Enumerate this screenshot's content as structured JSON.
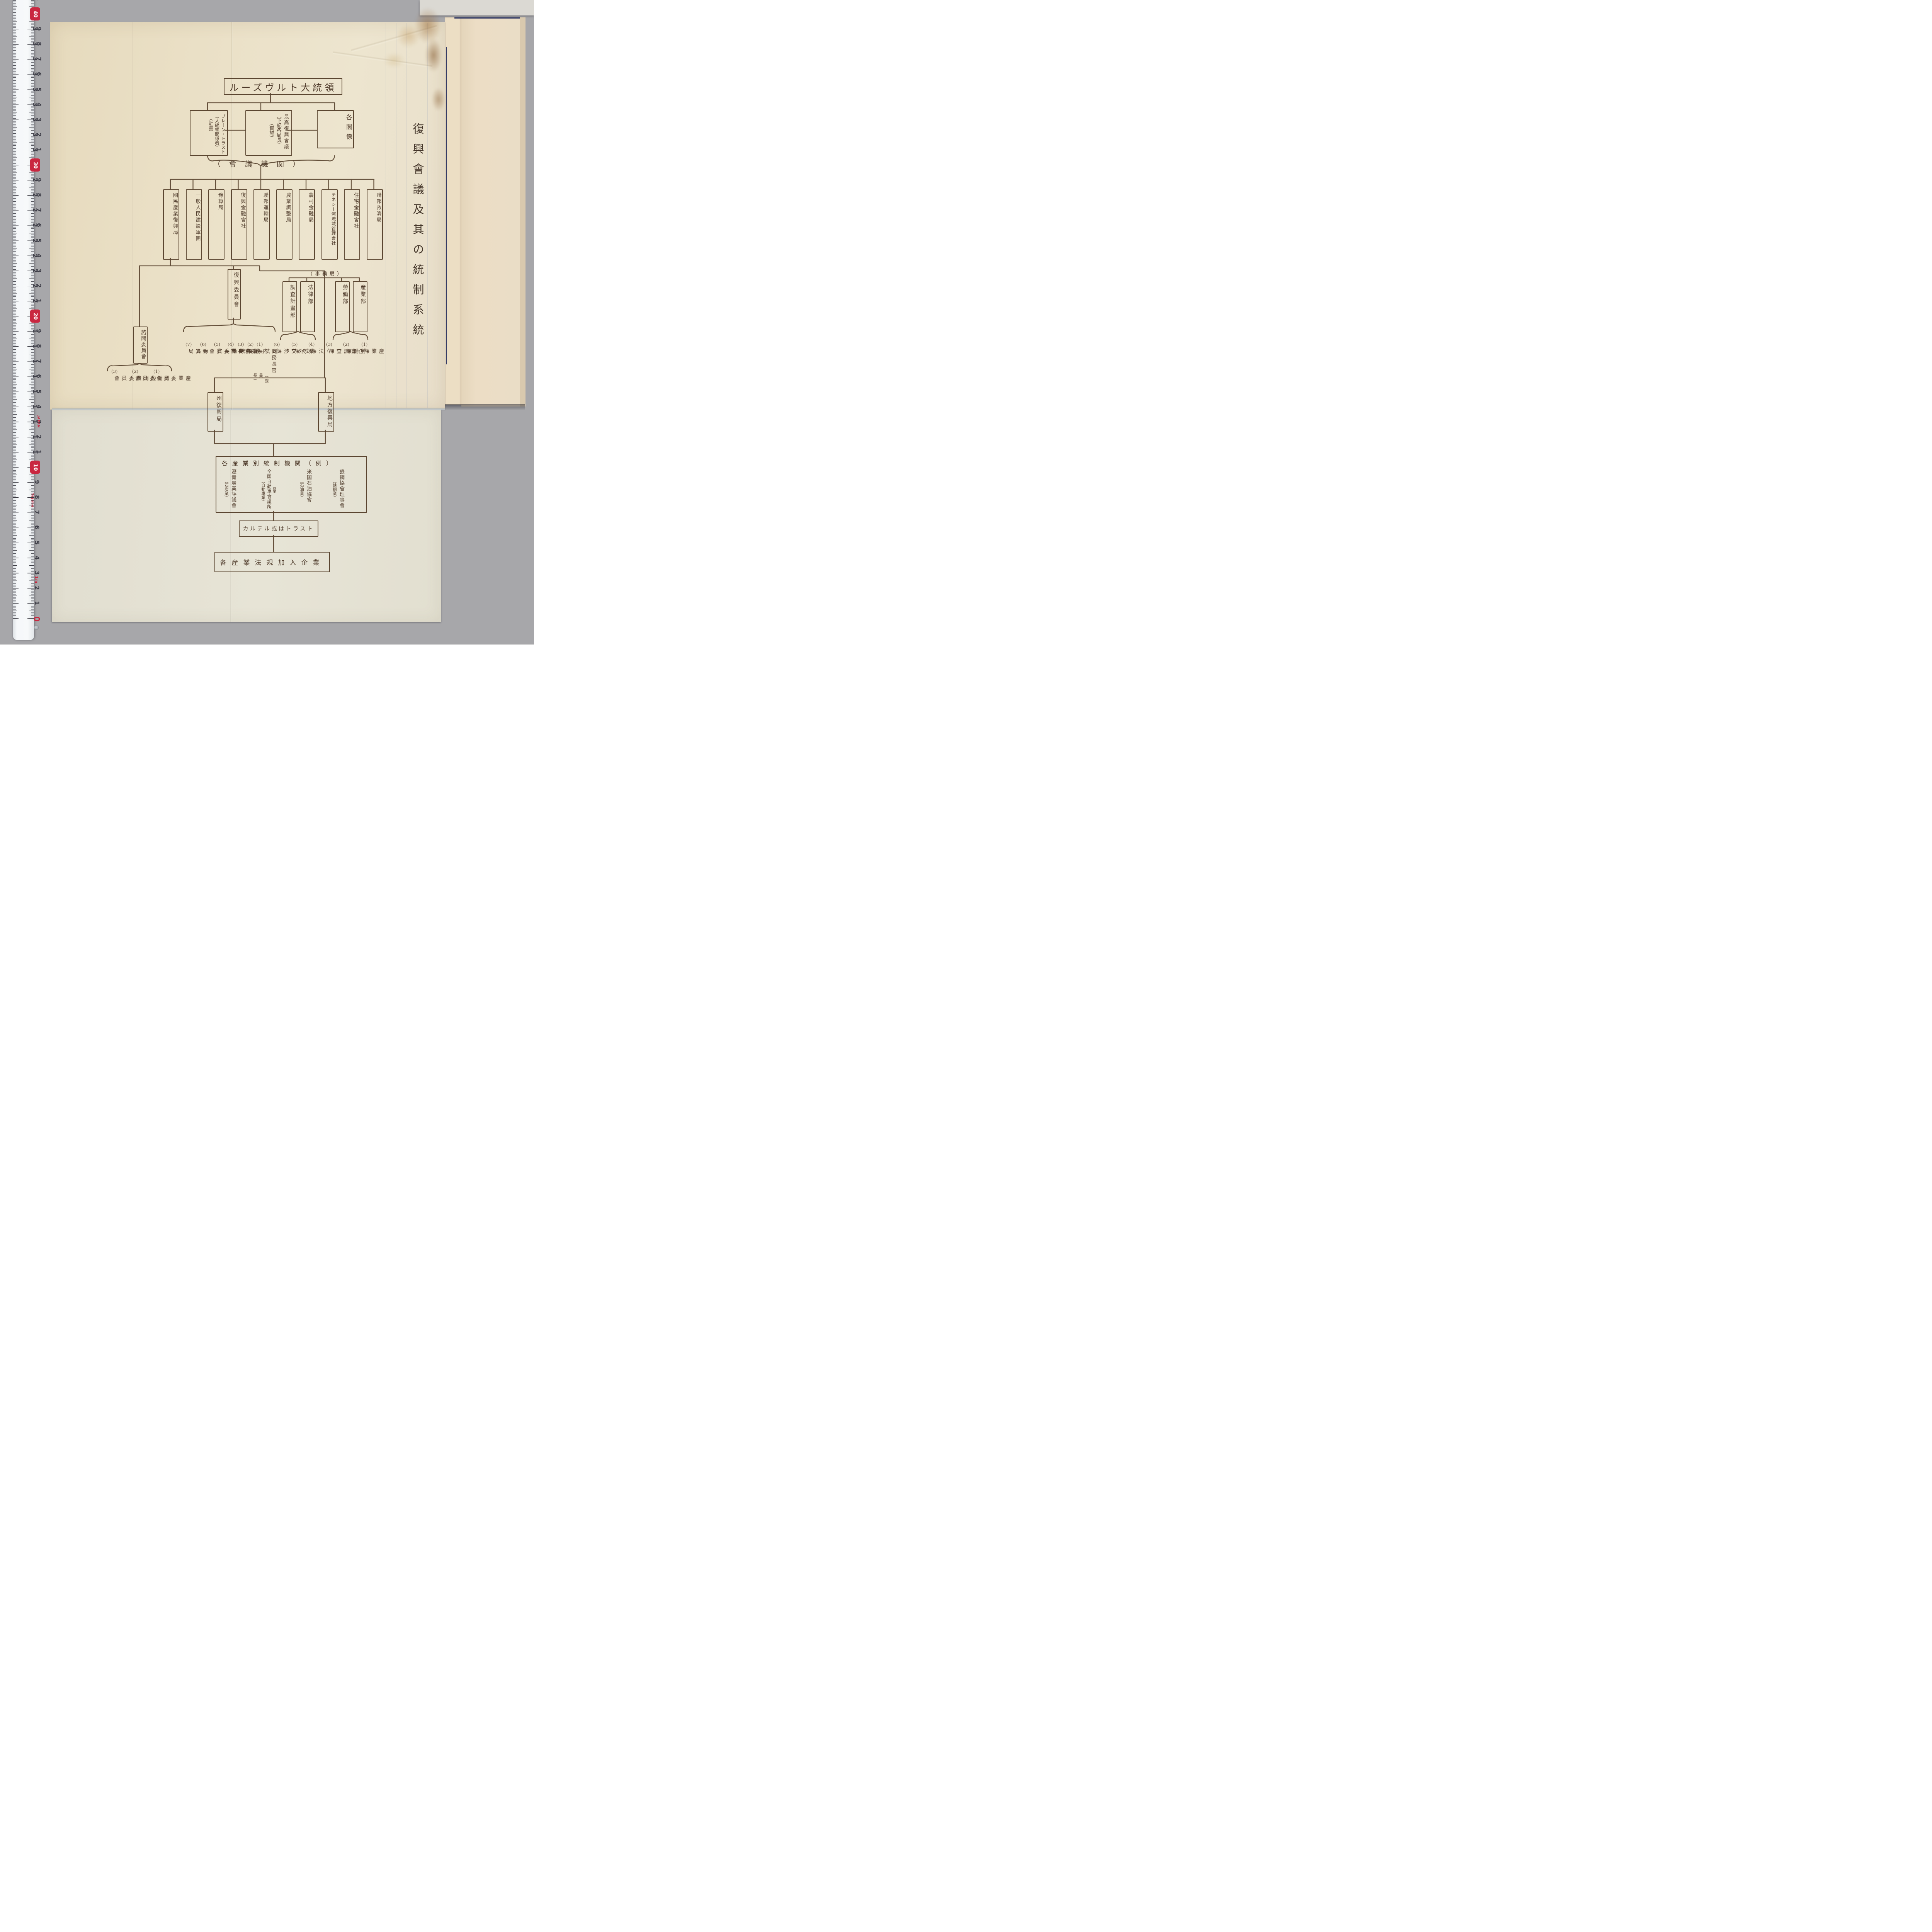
{
  "document": {
    "side_title": "復興會議及其の統制系統",
    "chart": {
      "president": "ルーズヴルト大統領",
      "row2": {
        "brain_trust": [
          "ブレーン・トラスト",
          "（大統領関係者）",
          "（計畫）"
        ],
        "supreme_council": [
          "最高復興會議",
          "（下記各局長）",
          "（實施）"
        ],
        "cabinet": "各閣僚"
      },
      "council_label": "（會議機関）",
      "agencies": [
        "國民産業復興局",
        "一般人民建設軍團",
        "豫算局",
        "復興金融會社",
        "聯邦運輸局",
        "農業調整局",
        "農村金融局",
        "テネシー河流域管理會社",
        "住宅金融會社",
        "聯邦救濟局"
      ],
      "recovery_committee": "復興委員會",
      "committee_members": [
        {
          "no": "(1)",
          "label": "商務長官",
          "sub": "（委員長）"
        },
        {
          "no": "(2)",
          "label": "司法長官",
          "sub": ""
        },
        {
          "no": "(3)",
          "label": "内務長官",
          "sub": ""
        },
        {
          "no": "(4)",
          "label": "農務長官",
          "sub": ""
        },
        {
          "no": "(5)",
          "label": "勞働長官",
          "sub": ""
        },
        {
          "no": "(6)",
          "label": "聯邦商業委員會",
          "sub": "議長"
        },
        {
          "no": "(7)",
          "label": "豫算局",
          "sub": ""
        }
      ],
      "secretariat_label": "（事務局）",
      "departments": [
        "調査計畫部",
        "法律部",
        "勞働部",
        "産業部"
      ],
      "dept_sections": [
        {
          "no": "(1)",
          "label": "産業課"
        },
        {
          "no": "(2)",
          "label": "勞働課"
        },
        {
          "no": "(3)",
          "label": "企畫調査課"
        },
        {
          "no": "(4)",
          "label": "立法課"
        },
        {
          "no": "(5)",
          "label": "業務課"
        },
        {
          "no": "(6)",
          "label": "對外交渉課"
        }
      ],
      "advisory_committee": "諮問委員會",
      "advisory_boards": [
        {
          "no": "(1)",
          "label": "産業委員會"
        },
        {
          "no": "(2)",
          "label": "勞働委員會"
        },
        {
          "no": "(3)",
          "label": "一般消費委員會"
        }
      ],
      "state_bureau": "州復興局",
      "local_bureau": "地方復興局",
      "industry_box": {
        "title": "各産業別統制機関（例）",
        "entries": [
          {
            "name": "鉄鋼協會理事會",
            "insert": "",
            "industry": "（鉄鋼業）"
          },
          {
            "name": "米国石油協會",
            "insert": "",
            "industry": "（石油業）"
          },
          {
            "name": "全国自動車會議所",
            "insert": "商業",
            "industry": "（自動車業）"
          },
          {
            "name": "瀝青炭業評議會",
            "insert": "",
            "industry": "（石炭業）"
          }
        ]
      },
      "cartel_box": "カルテル或はトラスト",
      "enterprises_box": "各産業法規加入企業"
    }
  },
  "ruler": {
    "brand": "Tajima",
    "origin": "JAPAN",
    "meter_label": "1m",
    "cm_min": 0,
    "cm_max": 41
  },
  "colors": {
    "ink": "#5b4631",
    "paper_top": "#eae0c6",
    "paper_bottom": "#e5e2d4",
    "page_under": "#ecdec4",
    "navy": "#333a64",
    "tape_red": "#c92740",
    "background": "#a7a7aa"
  }
}
